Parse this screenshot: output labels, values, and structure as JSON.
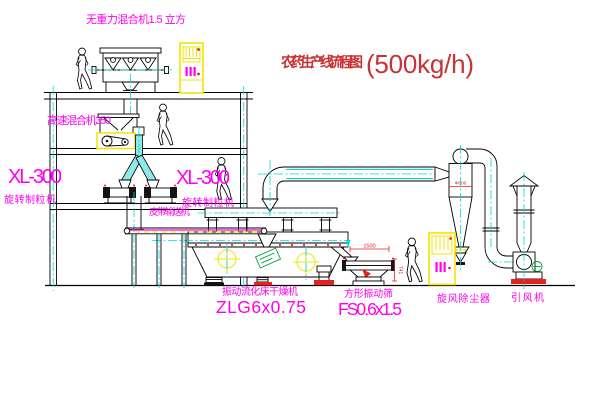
{
  "title": {
    "text": "农药生产线流程图",
    "capacity": "(500kg/h)"
  },
  "equipment_labels": {
    "gravity_mixer": "无重力混合机1.5 立方",
    "high_speed_mixer": "高速混合机350",
    "granulator_left": {
      "model": "XL-300",
      "name": "旋转制粒机"
    },
    "granulator_right": {
      "model": "XL-300",
      "name": "旋转制粒机"
    },
    "belt_conveyor": "皮带输送机",
    "fluid_bed_dryer": {
      "name": "振动流化床干燥机",
      "model": "ZLG6x0.75"
    },
    "vibrating_sieve": {
      "name": "方形振动筛",
      "model": "FS0.6x1.5"
    },
    "cyclone": "旋风除尘器",
    "induced_draft_fan": "引风机"
  },
  "dimensions": {
    "sieve_length": "1500",
    "sieve_height": "741",
    "cyclone_note": "Φ800"
  },
  "colors": {
    "label_magenta": "#ff00ee",
    "title_red": "#c93333",
    "dimension_red": "#e32222",
    "centerline_cyan": "#00d8d8",
    "cabinet_yellow": "#f2e400"
  }
}
